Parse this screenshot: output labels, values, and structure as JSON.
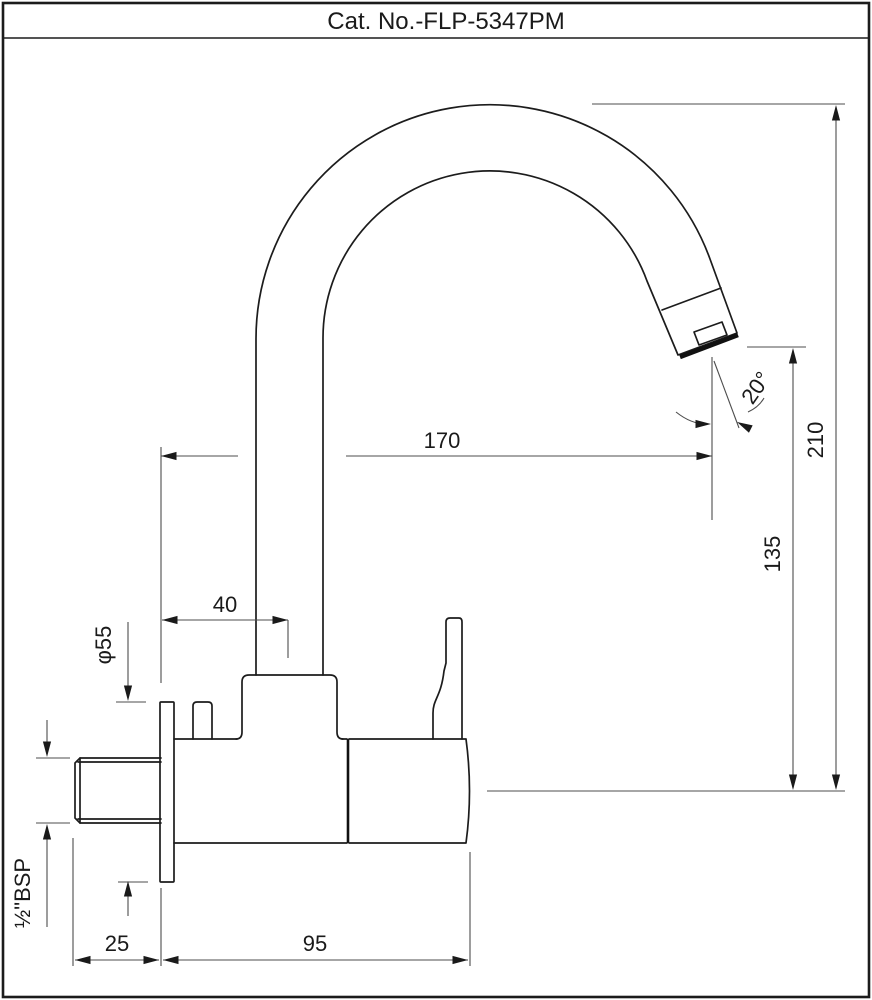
{
  "title": "Cat. No.-FLP-5347PM",
  "dimensions": {
    "spout_reach": "170",
    "overall_height": "210",
    "spout_clearance": "135",
    "riser_offset": "40",
    "flange_diameter": "φ55",
    "inlet_thread": "½\"BSP",
    "wall_projection": "25",
    "body_length": "95",
    "outlet_angle": "20°"
  }
}
